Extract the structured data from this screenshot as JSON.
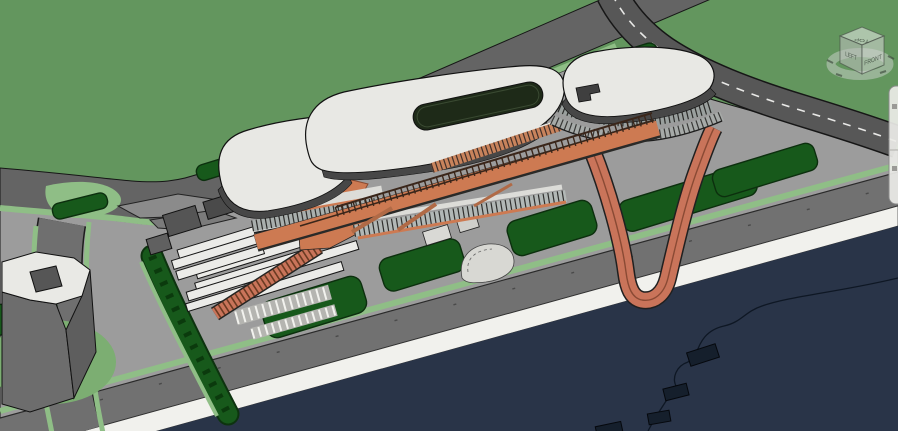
{
  "viewcube": {
    "top": "TOP",
    "left": "LEFT",
    "front": "FRONT"
  },
  "palette": {
    "terrain_green": "#63965e",
    "verge_green": "#8fbe86",
    "lawn_green": "#17591b",
    "context_lawn_green": "#7cae72",
    "water_navy": "#293448",
    "seawall_white": "#f1f1ed",
    "plaza_gray": "#9c9c9c",
    "road_gray": "#646464",
    "ramp_road_gray": "#575757",
    "roof_white": "#e8e8e4",
    "fascia_dark": "#474747",
    "walkway_orange": "#cd7a52",
    "loop_ramp_orange": "#c9745a",
    "truss_brown": "#3a261a",
    "outline_black": "#161616"
  },
  "icons": {
    "viewcube": "view-cube",
    "compass_ring": "compass-ring",
    "navigation_bar": "navigation-bar-fragment"
  }
}
